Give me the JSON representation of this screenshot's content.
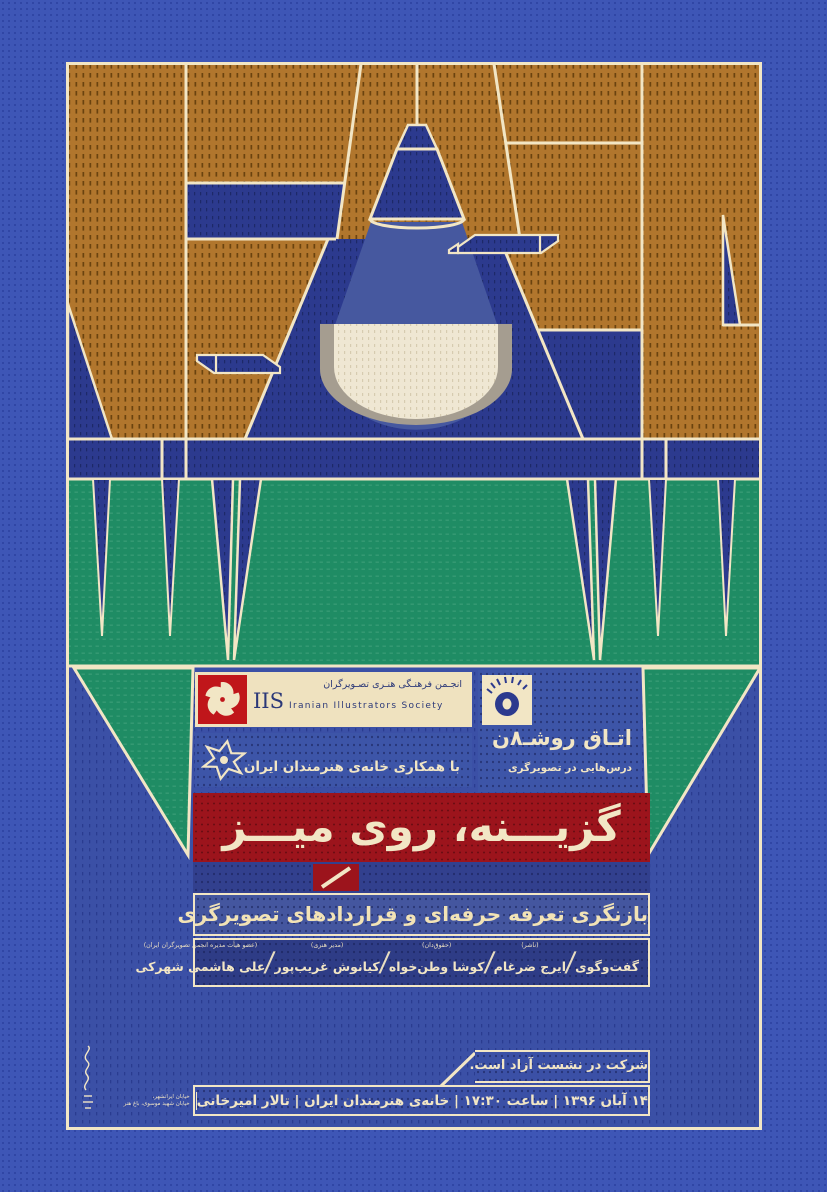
{
  "poster": {
    "colors": {
      "page_blue": "#3E56B6",
      "page_dot": "#2F44A3",
      "poster_navy": "#2C3A8E",
      "section_blue": "#3B50A6",
      "panel_blue": "#3D55A8",
      "strip_navy": "#32408E",
      "names_navy": "#2E3C86",
      "green": "#1F8C64",
      "brown": "#B1762D",
      "cream": "#F2E6C5",
      "text_navy": "#2B3878",
      "banner_red": "#9C141C",
      "logo_red": "#C0161A",
      "glow": "#EFE7D3"
    },
    "iis": {
      "name_fa": "انجـمن فرهنـگی هنـری تصـویرگران",
      "abbr_en": "IIS",
      "name_en": "Iranian Illustrators Society"
    },
    "series": {
      "title": "اتـاق روشـ۸ن",
      "subtitle": "درس‌هایی در تصویرگری"
    },
    "collaboration": {
      "text": "با همکاری خانه‌ی هنرمندان ایران"
    },
    "main_title": "گزیـــنه، روی میـــز",
    "subtitle": "بازنگری تعرفه حرفه‌ای و قراردادهای تصویرگری",
    "panel": {
      "intro": "گفت‌وگوی",
      "separator": "/",
      "participants": [
        {
          "name": "ایرج ضرغام",
          "role": "(ناشر)"
        },
        {
          "name": "کوشا وطن‌خواه",
          "role": "(حقوق‌دان)"
        },
        {
          "name": "کیانوش غریب‌پور",
          "role": "(مدیر هنری)"
        },
        {
          "name": "علی هاشمی شهرکی",
          "role": "(عضو هیأت مدیره انجمن تصویرگران ایران)"
        }
      ]
    },
    "footer": {
      "free_entry": "شرکت در نشست آزاد است.",
      "date_line": "۱۴ آبان ۱۳۹۶ | ساعت ۱۷:۳۰ | خانه‌ی هنرمندان ایران | تالار امیرخانی",
      "address_line1": "خیابان ایرانشهر،",
      "address_line2": "خیابان شهید موسوی، باغ هنر"
    }
  }
}
